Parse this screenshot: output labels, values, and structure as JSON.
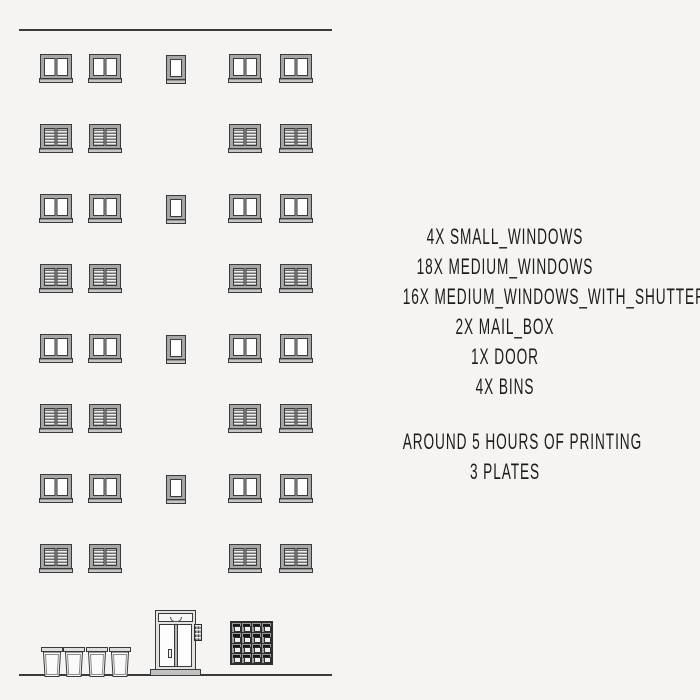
{
  "colors": {
    "background": "#f5f4f2",
    "line_ink": "#3a3a3a",
    "window_frame_gray": "#a6a6a6",
    "sill_gray": "#c6c6c6",
    "louver_dark": "#6e6e6e",
    "mailbox_dark": "#2e2e2e",
    "text_ink": "#1c1c1c"
  },
  "legend": {
    "items": [
      "4X SMALL_WINDOWS",
      "18X MEDIUM_WINDOWS",
      "16X MEDIUM_WINDOWS_WITH_SHUTTERS",
      "2X MAIL_BOX",
      "1X DOOR",
      "4X BINS"
    ],
    "notes": [
      "AROUND 5 HOURS OF PRINTING",
      "3 PLATES"
    ]
  },
  "facade": {
    "roofline": {
      "x": 19,
      "y": 29,
      "w": 313
    },
    "groundline": {
      "x": 19,
      "y": 674,
      "w": 313
    },
    "medium_window": {
      "w": 30,
      "h": 24,
      "sill_w": 34,
      "sill_h": 5
    },
    "small_window": {
      "w": 18,
      "h": 24,
      "sill_w": 20,
      "sill_h": 5
    },
    "window_rows": [
      {
        "y": 55,
        "type": "plain",
        "medium_x": [
          41,
          90,
          230,
          281
        ],
        "small_x": 167
      },
      {
        "y": 125,
        "type": "shutters",
        "medium_x": [
          41,
          90,
          230,
          281
        ]
      },
      {
        "y": 195,
        "type": "plain",
        "medium_x": [
          41,
          90,
          230,
          281
        ],
        "small_x": 167
      },
      {
        "y": 265,
        "type": "shutters",
        "medium_x": [
          41,
          90,
          230,
          281
        ]
      },
      {
        "y": 335,
        "type": "plain",
        "medium_x": [
          41,
          90,
          230,
          281
        ],
        "small_x": 167
      },
      {
        "y": 405,
        "type": "shutters",
        "medium_x": [
          41,
          90,
          230,
          281
        ]
      },
      {
        "y": 475,
        "type": "plain",
        "medium_x": [
          41,
          90,
          230,
          281
        ],
        "small_x": 167
      },
      {
        "y": 545,
        "type": "shutters",
        "medium_x": [
          41,
          90,
          230,
          281
        ]
      }
    ],
    "door": {
      "x": 155,
      "y": 610,
      "w": 41,
      "h": 60,
      "intercom": {
        "x": 194,
        "y": 624,
        "w": 8,
        "h": 17
      },
      "threshold": {
        "x": 150,
        "y": 669,
        "w": 51,
        "h": 7
      }
    },
    "mailbox": {
      "x": 230,
      "y": 621,
      "w": 43,
      "h": 44,
      "cols": 4,
      "rows": 4
    },
    "bins": {
      "xs": [
        41,
        63,
        86,
        109
      ],
      "y": 647,
      "w": 22,
      "h": 30
    }
  }
}
